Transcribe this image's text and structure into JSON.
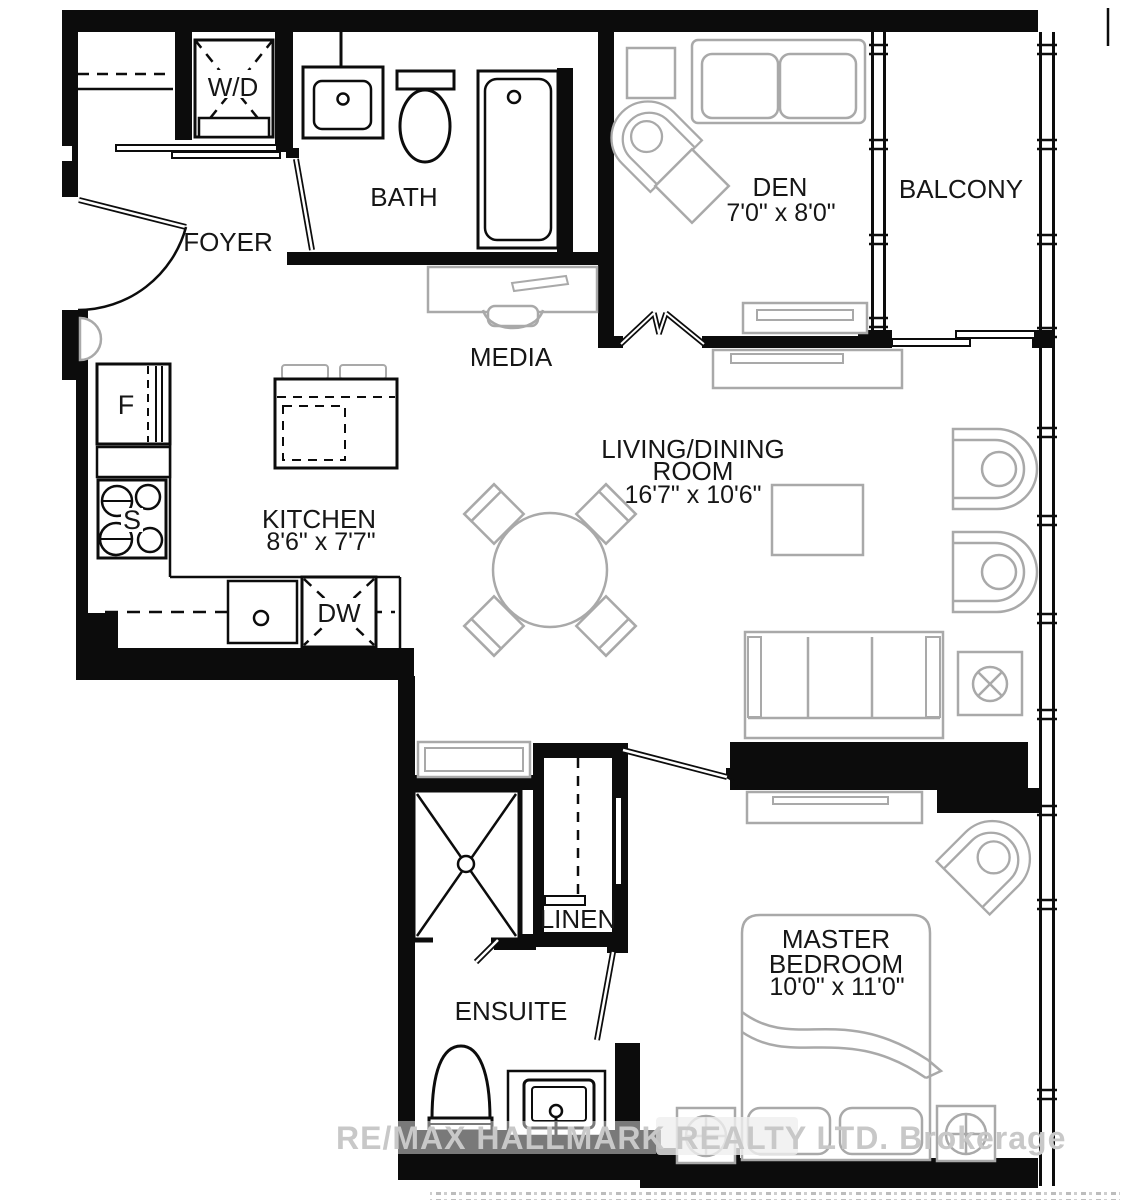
{
  "rooms": {
    "foyer": {
      "label": "FOYER"
    },
    "bath": {
      "label": "BATH"
    },
    "den": {
      "label": "DEN",
      "dims": "7'0\" x 8'0\""
    },
    "balcony": {
      "label": "BALCONY"
    },
    "media": {
      "label": "MEDIA"
    },
    "living": {
      "line1": "LIVING/DINING",
      "line2": "ROOM",
      "dims": "16'7\" x 10'6\""
    },
    "kitchen": {
      "label": "KITCHEN",
      "dims": "8'6\" x 7'7\""
    },
    "linen": {
      "label": "LINEN"
    },
    "ensuite": {
      "label": "ENSUITE"
    },
    "master": {
      "line1": "MASTER",
      "line2": "BEDROOM",
      "dims": "10'0\" x 11'0\""
    }
  },
  "fixtures": {
    "washer_dryer": "W/D",
    "fridge": "F",
    "stove": "S",
    "dishwasher": "DW"
  },
  "watermark": {
    "text": "RE/MAX HALLMARK REALTY LTD. Brokerage"
  },
  "colors": {
    "wall": "#0c0c0c",
    "furniture": "#a9a9a9",
    "watermark": "#c8c8c8"
  }
}
